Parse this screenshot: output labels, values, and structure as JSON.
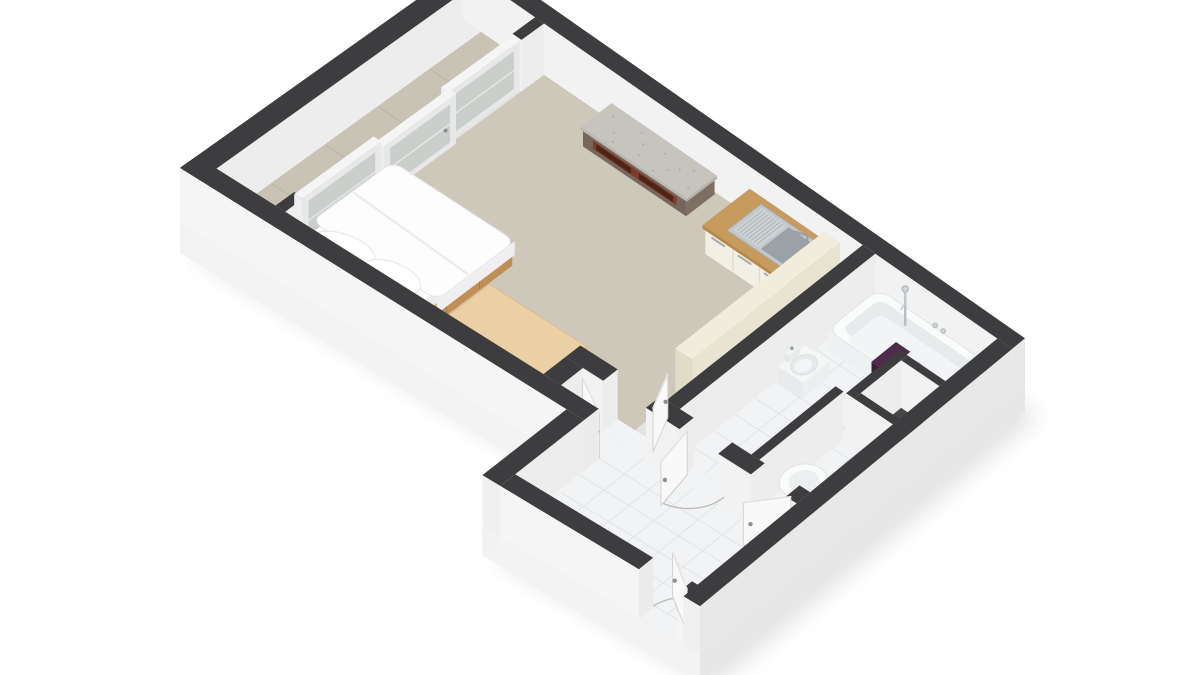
{
  "title": "3D axonometric floor plan of a studio apartment",
  "view": "dollhouse cutaway render, no visible text",
  "background": "#ffffff",
  "palette": {
    "wall_top": "#3d3d40",
    "wall_inner": "#ededed",
    "wall_face": "#f2f2f2",
    "wall_outer_bright": "#f5f5f5",
    "wall_outer_shade": "#e8e8e8",
    "plinth": "#f3f3f3",
    "plinth_shade": "#e7e7e7",
    "carpet": "#cec8bb",
    "balcony_floor": "#c9c3b5",
    "balcony_seam": "#bab4a6",
    "tile": "#f2f3f4",
    "tile_line": "#e2e4e6",
    "glass": "#c9cec9",
    "window_frame": "#f5f5f5",
    "wood_oak_top": "#c79a5e",
    "wood_oak_front": "#b5894a",
    "wood_oak_side": "#a87a3c",
    "maple_top": "#ead0a4",
    "maple_front": "#dec092",
    "maple_side": "#d0ad77",
    "bed_wood_top": "#d9b282",
    "bed_wood_front": "#cd9f6b",
    "bed_wood_side": "#c08f58",
    "bedding_white": "#fdfdfe",
    "cream_top": "#f1eddd",
    "cream_face": "#e9e4d2",
    "cream_side": "#e1dcc8",
    "cabinet_front": "#f2efe5",
    "marble_top": "#c7c4be",
    "marble_speckle": "#a8a49d",
    "console_top": "#8d7d71",
    "console_front": "#76675c",
    "console_side": "#7e6f64",
    "shelf_accent": "#7e3a2a",
    "shelf_slot": "#4f2418",
    "steel": "#c2c8cb",
    "steel_basin": "#9aa2a8",
    "steel_ridge": "#adb4b8",
    "chrome": "#9aa1a6",
    "fixture_white": "#fafcfc",
    "fixture_shade": "#e7ebec",
    "towel": "#4f2b4a",
    "towel_shade": "#3a1f3a",
    "shaft_floor": "#47474a",
    "door_leaf": "#f9f9f9",
    "door_edge": "#d4d4d4",
    "handle": "#8b9094",
    "swing_arc": "#bdbdbd",
    "shadow": "#222222"
  },
  "scene": {
    "rooms": [
      {
        "name": "living-bedroom",
        "floor": "beige carpet"
      },
      {
        "name": "balcony",
        "floor": "beige tile",
        "glazing": "3-panel full-height sliding window wall"
      },
      {
        "name": "kitchenette",
        "floor": "beige carpet"
      },
      {
        "name": "bathroom",
        "floor": "white tile"
      },
      {
        "name": "wc",
        "floor": "white tile"
      },
      {
        "name": "hallway",
        "floor": "white tile"
      },
      {
        "name": "closet",
        "floor": "white tile"
      }
    ],
    "furniture": [
      {
        "name": "double-bed",
        "details": "light wood frame with storage drawers, white duvet, 2 white pillows"
      },
      {
        "name": "wardrobe",
        "details": "large light-wood block"
      },
      {
        "name": "media-console",
        "details": "brown cabinet, speckled stone top, red-brown open shelf"
      },
      {
        "name": "kitchen-counter",
        "details": "wood worktop, cream fronts, stainless sink with drainer, chrome faucet"
      },
      {
        "name": "room-divider",
        "details": "cream partition with wood desk ledge on bathroom side"
      }
    ],
    "fixtures": [
      {
        "name": "bathtub",
        "details": "white tub along top wall, chrome hand shower and wall controls"
      },
      {
        "name": "towel-on-tub",
        "color": "#4f2b4a"
      },
      {
        "name": "bidet"
      },
      {
        "name": "toilet"
      },
      {
        "name": "service-shaft",
        "details": "dark square recess in far corner"
      }
    ],
    "doors": {
      "interior_count": 4,
      "entry_count": 1,
      "style": "white leaves shown open, floor swing marks"
    },
    "windows": {
      "panel_count": 3,
      "style": "white frames, grey glazing"
    }
  }
}
